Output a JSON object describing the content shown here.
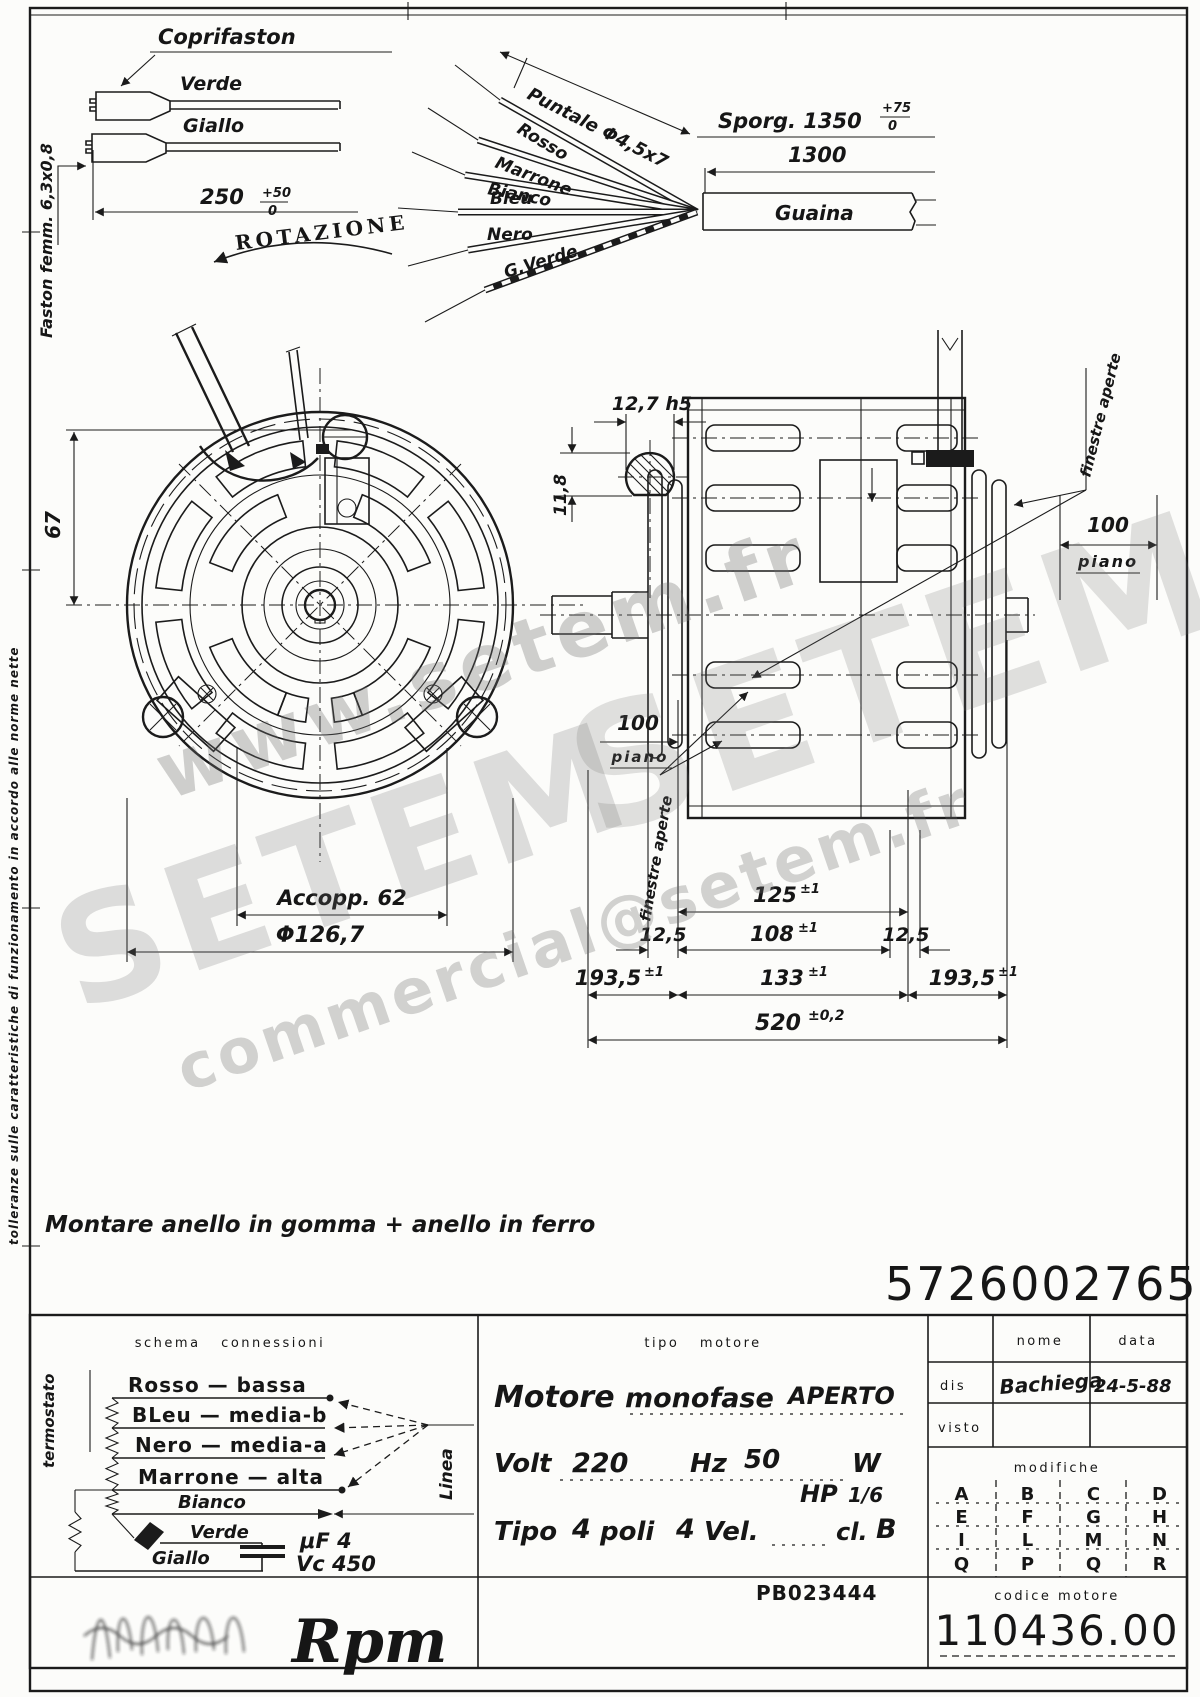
{
  "margin_note": "tolleranze sulle caratteristiche di funzionamento in accordo alle norme nette",
  "connector_detail": {
    "coprifaston": "Coprifaston",
    "verde": "Verde",
    "giallo": "Giallo",
    "dim": "250",
    "dim_tol_top": "+50",
    "dim_tol_bot": "0",
    "faston_note": "Faston femm. 6,3x0,8"
  },
  "rotazione": "ROTAZIONE",
  "cable_detail": {
    "puntale": "Puntale Φ4,5x7",
    "rosso": "Rosso",
    "marrone": "Marrone",
    "bianco": "Bianco",
    "bleu": "Bleu",
    "nero": "Nero",
    "gverde": "G.Verde",
    "sporg": "Sporg. 1350",
    "sporg_tol_top": "+75",
    "sporg_tol_bot": "0",
    "dim_1300": "1300",
    "guaina": "Guaina"
  },
  "front_view": {
    "dim_67": "67",
    "accopp": "Accopp. 62",
    "diam": "Φ126,7"
  },
  "side_view": {
    "dim_shaft_w": "12,7 h5",
    "dim_shaft_h": "11,8",
    "finestre_right": "finestre aperte",
    "finestre_left": "finestre aperte",
    "piano_right_val": "100",
    "piano_right_lbl": "piano",
    "piano_left_val": "100",
    "piano_left_lbl": "piano",
    "d125": "125",
    "d125_tol": "±1",
    "d108": "108",
    "d108_tol": "±1",
    "d125l": "12,5",
    "d125r": "12,5",
    "d133": "133",
    "d133_tol": "±1",
    "d1935l": "193,5",
    "d1935l_tol": "±1",
    "d1935r": "193,5",
    "d1935r_tol": "±1",
    "d520": "520",
    "d520_tol": "±0,2"
  },
  "note": "Montare anello in gomma + anello in ferro",
  "drawing_number": "5726002765",
  "watermark": {
    "w1": "www.setem.fr",
    "w2": "SETEM",
    "w3": "SETEM",
    "w4": "commercial@setem.fr"
  },
  "title_block": {
    "schema": {
      "header": "schema  connessioni",
      "termostato": "termostato",
      "row1": "Rosso — bassa",
      "row2": "BLeu — media-b",
      "row3": "Nero — media-a",
      "row4": "Marrone — alta",
      "bianco": "Bianco",
      "verde": "Verde",
      "giallo": "Giallo",
      "cap1": "μF 4",
      "cap2": "Vc 450",
      "linea": "Linea"
    },
    "tipo": {
      "header": "tipo  motore",
      "motore": "Motore",
      "monofase": "monofase",
      "aperto": "APERTO",
      "volt_l": "Volt",
      "volt_v": "220",
      "hz_l": "Hz",
      "hz_v": "50",
      "w_l": "W",
      "hp_l": "HP",
      "hp_v": "1/6",
      "tipo_l": "Tipo",
      "tipo_v": "4",
      "poli_l": "poli",
      "poli_v": "4",
      "vel_l": "Vel.",
      "cl_l": "cl.",
      "cl_v": "B",
      "pb": "PB023444"
    },
    "approvals": {
      "nome": "nome",
      "data": "data",
      "dis": "dis",
      "dis_name": "Bachiega",
      "dis_date": "24-5-88",
      "visto": "visto"
    },
    "modifiche": {
      "header": "modifiche",
      "c1": [
        "A",
        "E",
        "I",
        "Q"
      ],
      "c2": [
        "B",
        "F",
        "L",
        "P"
      ],
      "c3": [
        "C",
        "G",
        "M",
        "Q"
      ],
      "c4": [
        "D",
        "H",
        "N",
        "R"
      ]
    },
    "codice": {
      "label": "codice motore",
      "value": "110436.00"
    },
    "logo": "Rpm"
  }
}
